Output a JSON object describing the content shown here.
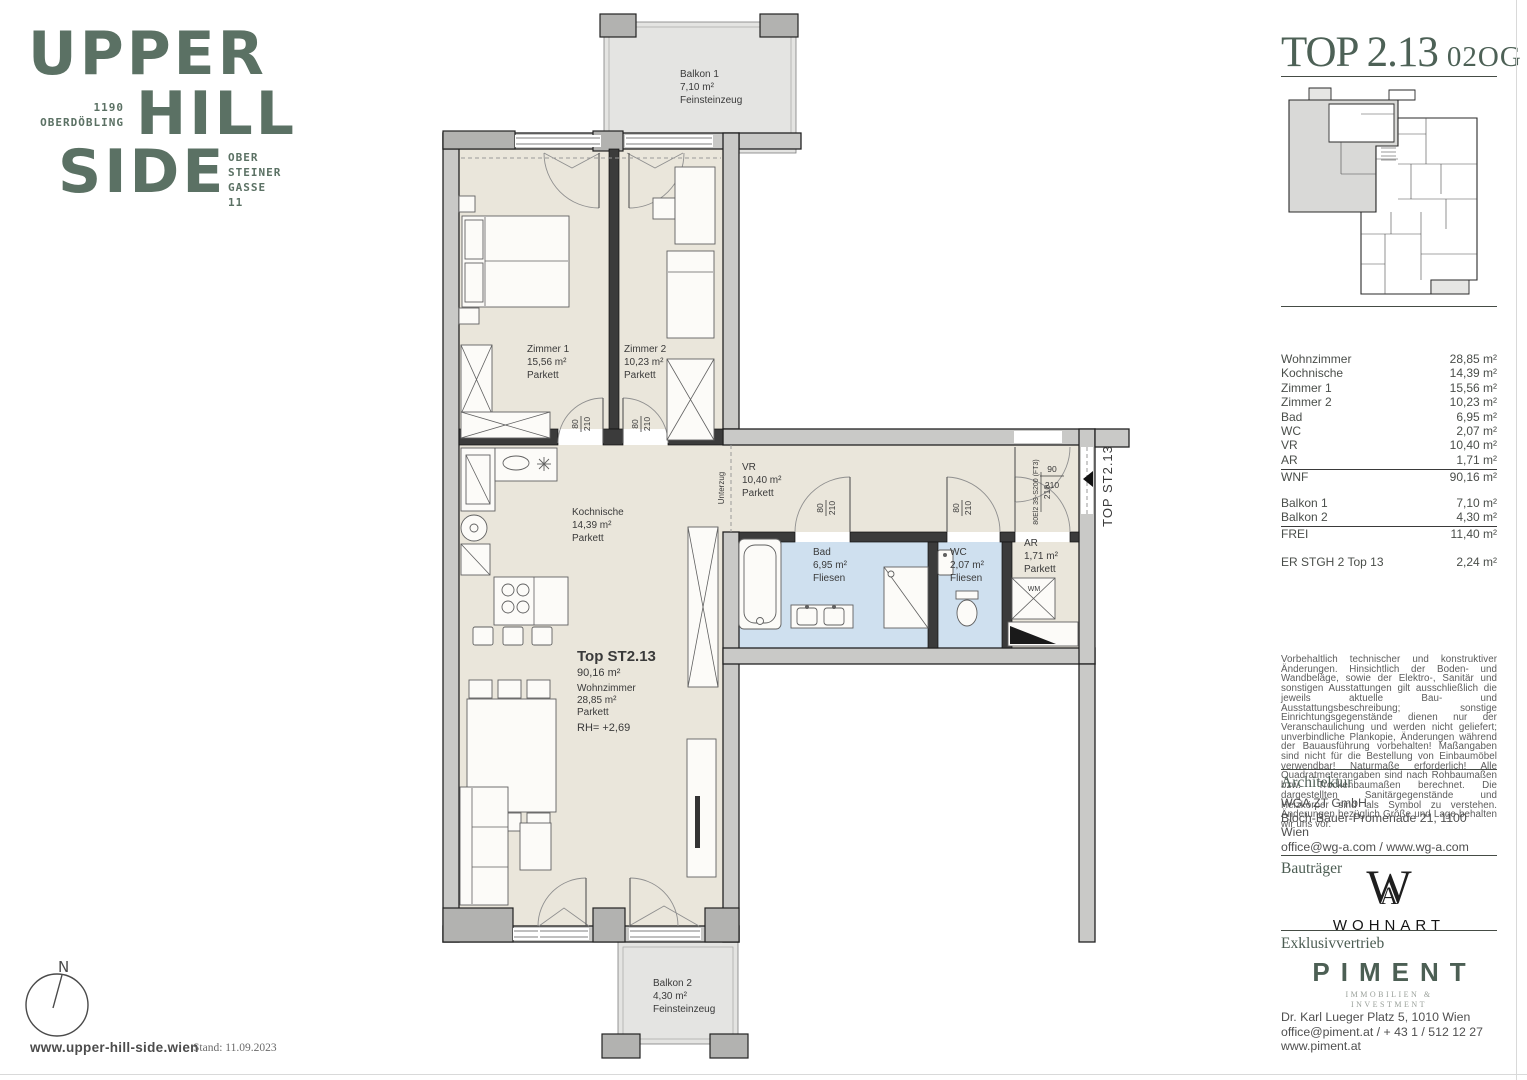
{
  "colors": {
    "brand_green": "#5b7164",
    "title_green": "#4d6156",
    "floor_beige": "#eae6db",
    "floor_tile_blue": "#cfe0ef",
    "wall_gray": "#c9c9c7"
  },
  "brand": {
    "word1": "UPPER",
    "word2": "HILL",
    "word3": "SIDE",
    "district": "1190\nOBERDÖBLING",
    "address": "OBER\nSTEINER\nGASSE\n11"
  },
  "plan": {
    "balkon1": {
      "name": "Balkon 1",
      "area": "7,10 m²",
      "floor": "Feinsteinzeug"
    },
    "balkon2": {
      "name": "Balkon 2",
      "area": "4,30 m²",
      "floor": "Feinsteinzeug"
    },
    "zimmer1": {
      "name": "Zimmer 1",
      "area": "15,56 m²",
      "floor": "Parkett"
    },
    "zimmer2": {
      "name": "Zimmer 2",
      "area": "10,23 m²",
      "floor": "Parkett"
    },
    "kochnische": {
      "name": "Kochnische",
      "area": "14,39 m²",
      "floor": "Parkett"
    },
    "vr": {
      "name": "VR",
      "area": "10,40 m²",
      "floor": "Parkett"
    },
    "bad": {
      "name": "Bad",
      "area": "6,95 m²",
      "floor": "Fliesen"
    },
    "wc": {
      "name": "WC",
      "area": "2,07 m²",
      "floor": "Fliesen"
    },
    "ar": {
      "name": "AR",
      "area": "1,71 m²",
      "floor": "Parkett"
    },
    "unit": {
      "label": "Top ST2.13",
      "area": "90,16 m²",
      "room": "Wohnzimmer",
      "room_area": "28,85 m²",
      "floor": "Parkett",
      "rh": "RH= +2,69"
    },
    "doors": {
      "w80": "80",
      "w90": "90",
      "h210": "210",
      "entrance_spec": "80El2 39-S200 (FT3)"
    },
    "notes": {
      "unterzug": "Unterzug",
      "entrance_tag": "TOP ST2.13",
      "wm": "WM"
    }
  },
  "panel": {
    "title": "TOP 2.13",
    "floor_tag": "02OG",
    "table": {
      "rows": [
        {
          "label": "Wohnzimmer",
          "value": "28,85 m²"
        },
        {
          "label": "Kochnische",
          "value": "14,39 m²"
        },
        {
          "label": "Zimmer 1",
          "value": "15,56 m²"
        },
        {
          "label": "Zimmer 2",
          "value": "10,23 m²"
        },
        {
          "label": "Bad",
          "value": "6,95 m²"
        },
        {
          "label": "WC",
          "value": "2,07 m²"
        },
        {
          "label": "VR",
          "value": "10,40 m²"
        },
        {
          "label": "AR",
          "value": "1,71 m²"
        }
      ],
      "wnf": {
        "label": "WNF",
        "value": "90,16 m²"
      },
      "balkon_rows": [
        {
          "label": "Balkon 1",
          "value": "7,10 m²"
        },
        {
          "label": "Balkon 2",
          "value": "4,30 m²"
        }
      ],
      "frei": {
        "label": "FREI",
        "value": "11,40 m²"
      },
      "extra": {
        "label": "ER STGH 2 Top 13",
        "value": "2,24 m²"
      }
    },
    "disclaimer": "Vorbehaltlich technischer und konstruktiver Änderungen. Hinsichtlich der Boden- und Wandbeläge, sowie der Elektro-, Sanitär und sonstigen Ausstattungen gilt ausschließlich die jeweils aktuelle Bau- und Ausstattungsbeschreibung; sonstige Einrichtungsgegenstände dienen nur der Veranschaulichung und werden nicht geliefert; unverbindliche Plankopie, Änderungen während der Bauausführung vorbehalten! Maßangaben sind nicht für die Bestellung von Einbaumöbel verwendbar! Naturmaße erforderlich! Alle Quadratmeterangaben sind nach Rohbaumaßen bzw. Trockenbaumaßen berechnet. Die dargestellten Sanitärgegenstände und Heizkörper sind als Symbol zu verstehen. Änderungen bezüglich Größe und Lage behalten wir uns vor.",
    "architektur": {
      "heading": "Architektur",
      "line1": "WGA ZT GmbH",
      "line2": "Bloch-Bauer-Promenade 21, 1100 Wien",
      "line3": "office@wg-a.com / www.wg-a.com"
    },
    "bautraeger": {
      "heading": "Bauträger",
      "logo_w": "W",
      "logo_a": "A",
      "logo_text": "WOHNART"
    },
    "vertrieb": {
      "heading": "Exklusivvertrieb",
      "logo": "PIMENT",
      "logo_sub1": "IMMOBILIEN &",
      "logo_sub2": "INVESTMENT",
      "line1": "Dr. Karl Lueger Platz 5, 1010 Wien",
      "line2": "office@piment.at / + 43 1 / 512 12 27",
      "line3": "www.piment.at"
    }
  },
  "footer": {
    "compass": "N",
    "website": "www.upper-hill-side.wien",
    "stand": "Stand: 11.09.2023"
  }
}
